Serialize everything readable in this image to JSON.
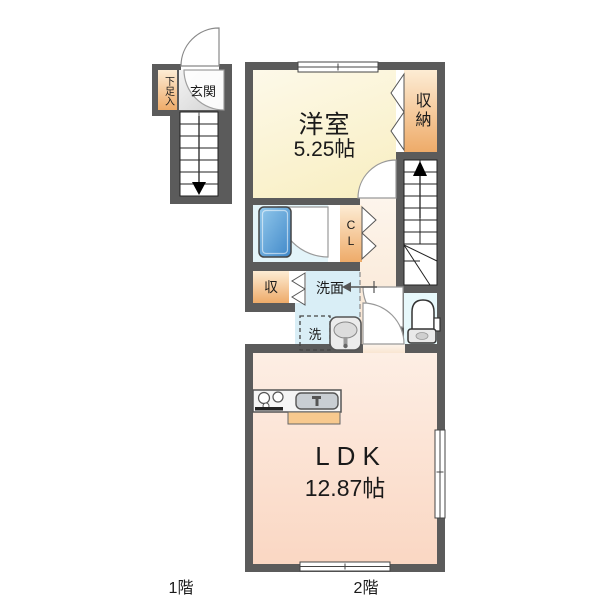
{
  "floor_plan": {
    "floors": [
      {
        "label": "1階"
      },
      {
        "label": "2階"
      }
    ],
    "rooms": {
      "genkan": {
        "label": "玄関"
      },
      "shoe_box": {
        "label": "下足入"
      },
      "western_room": {
        "label": "洋室",
        "size": "5.25帖"
      },
      "closet": {
        "label": "収納"
      },
      "cl_closet": {
        "label": "CL"
      },
      "storage": {
        "label": "収"
      },
      "washroom": {
        "label": "洗面"
      },
      "laundry": {
        "label": "洗"
      },
      "ldk": {
        "label": "LDK",
        "size": "12.87帖"
      }
    },
    "icons": [
      "bathtub-icon",
      "toilet-icon",
      "washbasin-icon",
      "stove-icon",
      "kitchen-sink-icon",
      "stairs-up-arrow-icon",
      "stairs-down-arrow-icon",
      "entry-arrow-icon",
      "door-swing-arc-icon",
      "folding-door-icon",
      "window-icon"
    ],
    "colors": {
      "wall": "#5b5b5b",
      "western_room": "#f8eec0",
      "storage_orange": "#eeab69",
      "bath_room": "#e3f4f9",
      "bathtub": "#4a8fcf",
      "washroom": "#d9eef6",
      "toilet_room": "#e7f8fb",
      "hallway": "#f9e5d1",
      "ldk": "#fad7c3",
      "genkan": "#d2d2d2",
      "kitchen_counter_strip": "#f7c98e"
    }
  }
}
